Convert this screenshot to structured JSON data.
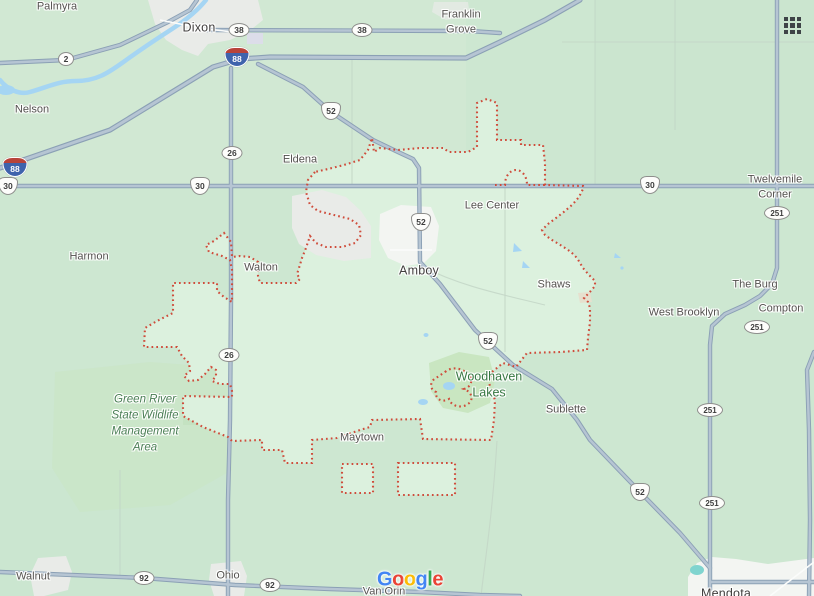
{
  "map": {
    "labels": [
      {
        "id": "palmyra",
        "text": "Palmyra",
        "x": 57,
        "y": 7,
        "type": "town"
      },
      {
        "id": "dixon",
        "text": "Dixon",
        "x": 199,
        "y": 28,
        "type": "city"
      },
      {
        "id": "franklin-grove",
        "text": "Franklin\nGrove",
        "x": 461,
        "y": 23,
        "type": "town"
      },
      {
        "id": "nelson",
        "text": "Nelson",
        "x": 32,
        "y": 110,
        "type": "town"
      },
      {
        "id": "eldena",
        "text": "Eldena",
        "x": 300,
        "y": 160,
        "type": "town"
      },
      {
        "id": "lee-center",
        "text": "Lee Center",
        "x": 492,
        "y": 206,
        "type": "town"
      },
      {
        "id": "twelvemile-corner",
        "text": "Twelvemile\nCorner",
        "x": 775,
        "y": 188,
        "type": "town"
      },
      {
        "id": "harmon",
        "text": "Harmon",
        "x": 89,
        "y": 257,
        "type": "town"
      },
      {
        "id": "walton",
        "text": "Walton",
        "x": 261,
        "y": 268,
        "type": "town"
      },
      {
        "id": "amboy",
        "text": "Amboy",
        "x": 419,
        "y": 271,
        "type": "city"
      },
      {
        "id": "shaws",
        "text": "Shaws",
        "x": 554,
        "y": 285,
        "type": "town"
      },
      {
        "id": "the-burg",
        "text": "The Burg",
        "x": 755,
        "y": 285,
        "type": "town"
      },
      {
        "id": "west-brooklyn",
        "text": "West Brooklyn",
        "x": 684,
        "y": 313,
        "type": "town"
      },
      {
        "id": "compton",
        "text": "Compton",
        "x": 781,
        "y": 309,
        "type": "town"
      },
      {
        "id": "green-river-swma",
        "text": "Green River\nState Wildlife\nManagement\nArea",
        "x": 145,
        "y": 424,
        "type": "area"
      },
      {
        "id": "woodhaven-lakes",
        "text": "Woodhaven\nLakes",
        "x": 489,
        "y": 385,
        "type": "park"
      },
      {
        "id": "sublette",
        "text": "Sublette",
        "x": 566,
        "y": 410,
        "type": "town"
      },
      {
        "id": "maytown",
        "text": "Maytown",
        "x": 362,
        "y": 438,
        "type": "town"
      },
      {
        "id": "walnut",
        "text": "Walnut",
        "x": 33,
        "y": 577,
        "type": "town"
      },
      {
        "id": "ohio",
        "text": "Ohio",
        "x": 228,
        "y": 576,
        "type": "town"
      },
      {
        "id": "van-orin",
        "text": "Van Orin",
        "x": 384,
        "y": 592,
        "type": "town"
      },
      {
        "id": "mendota",
        "text": "Mendota",
        "x": 726,
        "y": 594,
        "type": "city"
      }
    ],
    "shields": [
      {
        "type": "state",
        "num": "2",
        "x": 66,
        "y": 59
      },
      {
        "type": "state",
        "num": "38",
        "x": 239,
        "y": 30
      },
      {
        "type": "state",
        "num": "38",
        "x": 362,
        "y": 30
      },
      {
        "type": "interstate",
        "num": "88",
        "x": 237,
        "y": 57
      },
      {
        "type": "interstate",
        "num": "88",
        "x": 15,
        "y": 167
      },
      {
        "type": "us",
        "num": "30",
        "x": 8,
        "y": 186
      },
      {
        "type": "us",
        "num": "30",
        "x": 200,
        "y": 186
      },
      {
        "type": "us",
        "num": "30",
        "x": 650,
        "y": 185
      },
      {
        "type": "state",
        "num": "26",
        "x": 232,
        "y": 153
      },
      {
        "type": "state",
        "num": "26",
        "x": 229,
        "y": 355
      },
      {
        "type": "us",
        "num": "52",
        "x": 331,
        "y": 111
      },
      {
        "type": "us",
        "num": "52",
        "x": 421,
        "y": 222
      },
      {
        "type": "us",
        "num": "52",
        "x": 488,
        "y": 341
      },
      {
        "type": "us",
        "num": "52",
        "x": 640,
        "y": 492
      },
      {
        "type": "state",
        "num": "251",
        "x": 777,
        "y": 213
      },
      {
        "type": "state",
        "num": "251",
        "x": 757,
        "y": 327
      },
      {
        "type": "state",
        "num": "251",
        "x": 710,
        "y": 410
      },
      {
        "type": "state",
        "num": "251",
        "x": 712,
        "y": 503
      },
      {
        "type": "state",
        "num": "92",
        "x": 144,
        "y": 578
      },
      {
        "type": "state",
        "num": "92",
        "x": 270,
        "y": 585
      }
    ],
    "watermark": {
      "letters": [
        {
          "ch": "G",
          "color": "#4285F4"
        },
        {
          "ch": "o",
          "color": "#EA4335"
        },
        {
          "ch": "o",
          "color": "#FBBC05"
        },
        {
          "ch": "g",
          "color": "#4285F4"
        },
        {
          "ch": "l",
          "color": "#34A853"
        },
        {
          "ch": "e",
          "color": "#EA4335"
        }
      ]
    },
    "apps_grid_icon": {
      "rows": 3,
      "cols": 3
    }
  },
  "colors": {
    "base": "#cde7d1",
    "region": "#dcf1de",
    "boundary": "#cf4c3b",
    "road_casing": "#8ba0b5",
    "road_fill": "#b6c5d3",
    "minor": "#c3d6c7",
    "water": "#a5d5f3",
    "water_teal": "#7fd4cf",
    "urban": "#e9ebe8",
    "urban_light": "#f3f5f2",
    "park": "#c9e6c1",
    "town_label": "#54524f",
    "city_label": "#413f3e",
    "area_label": "#4b7f55",
    "park_label": "#377842",
    "grid_icon": "#3e4347"
  }
}
